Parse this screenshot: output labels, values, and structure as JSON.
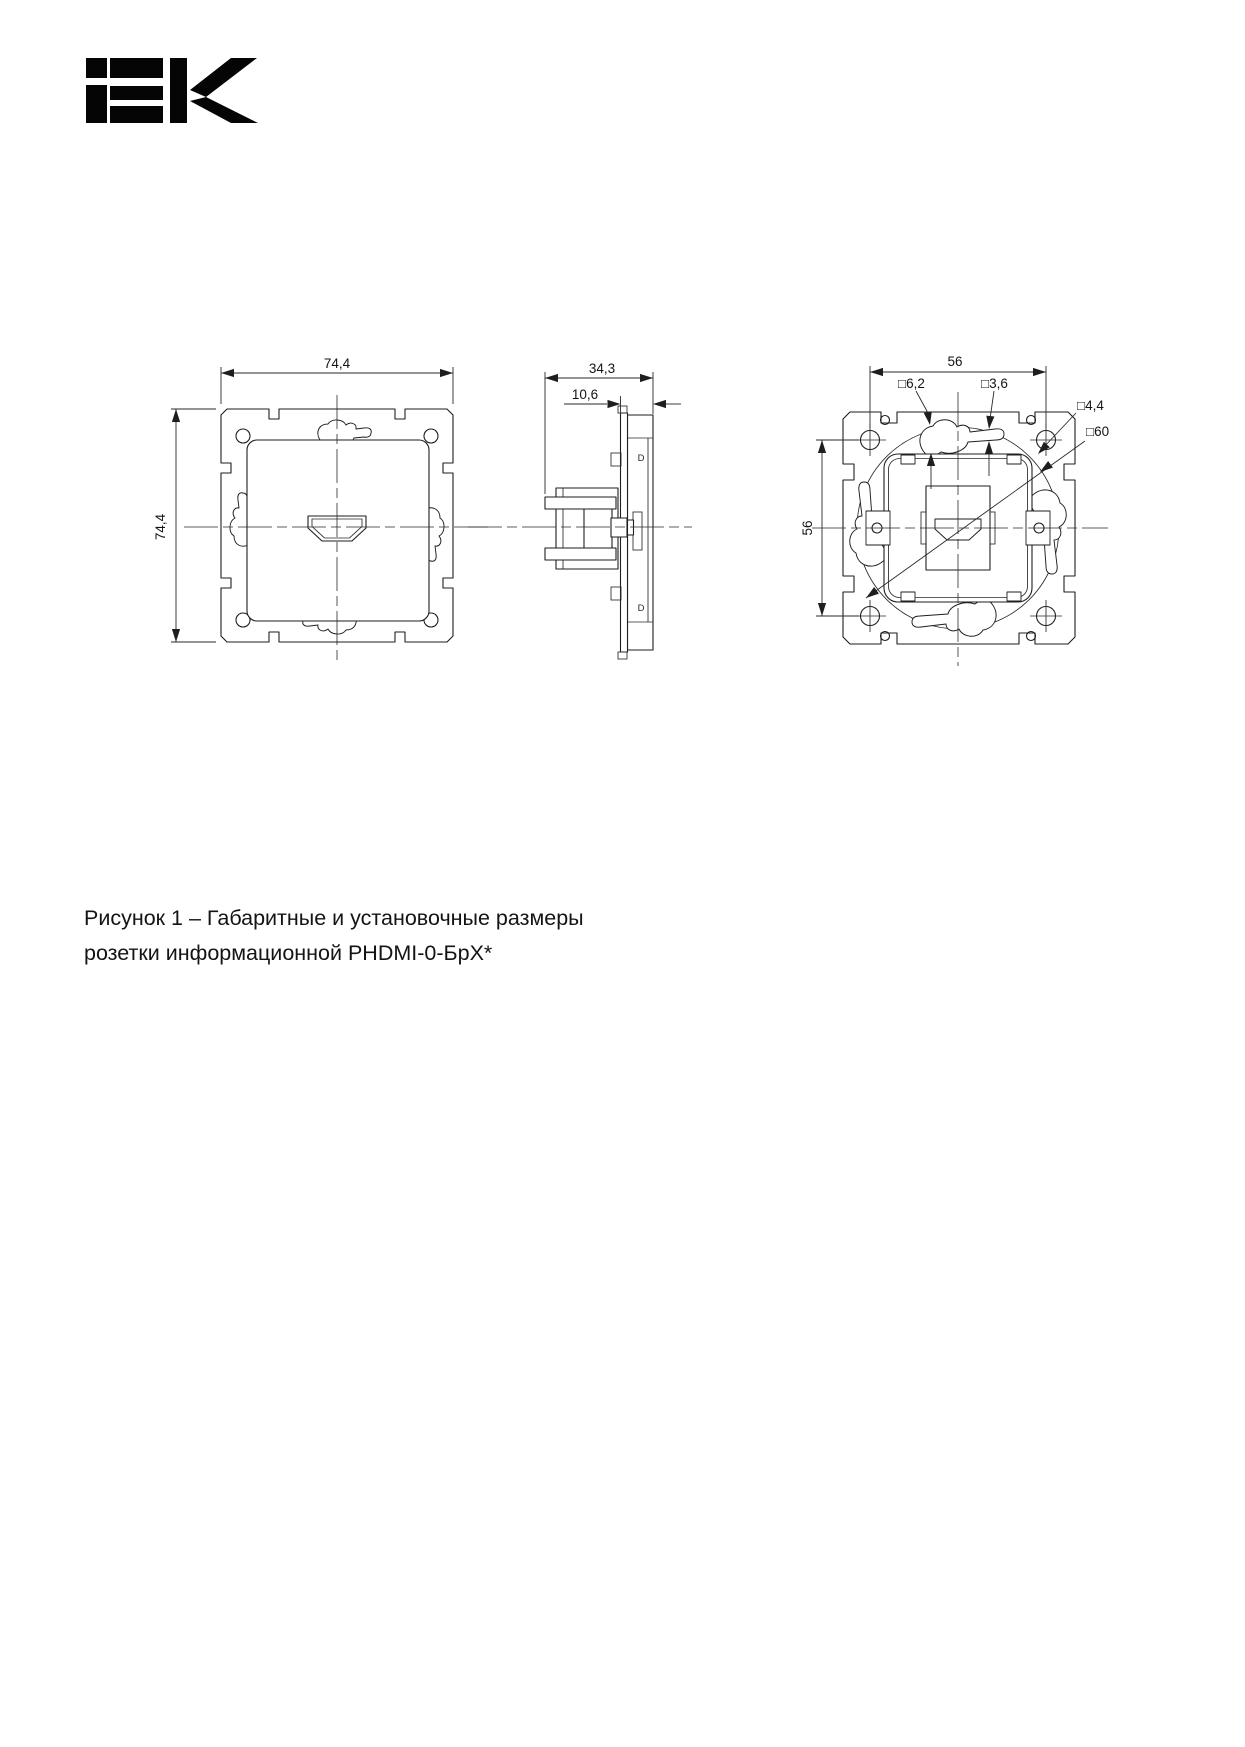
{
  "page": {
    "background": "#ffffff"
  },
  "logo": {
    "brand": "iEK",
    "color": "#050505"
  },
  "caption": {
    "line1": "Рисунок 1 – Габаритные и установочные размеры",
    "line2": "розетки информационной PHDMI-0-БрХ*"
  },
  "drawing": {
    "line_color": "#1e1e1e",
    "front_view": {
      "width_dim": "74,4",
      "height_dim": "74,4"
    },
    "side_view": {
      "depth_dim": "34,3",
      "offset_dim": "10,6",
      "mark_top": "D",
      "mark_bottom": "D"
    },
    "rear_view": {
      "hole_span_horizontal": "56",
      "hole_span_vertical": "56",
      "claw_slot_dim": "□6,2",
      "claw_arm_dim": "□3,6",
      "hole_dim": "□4,4",
      "square_dim": "□60"
    }
  }
}
